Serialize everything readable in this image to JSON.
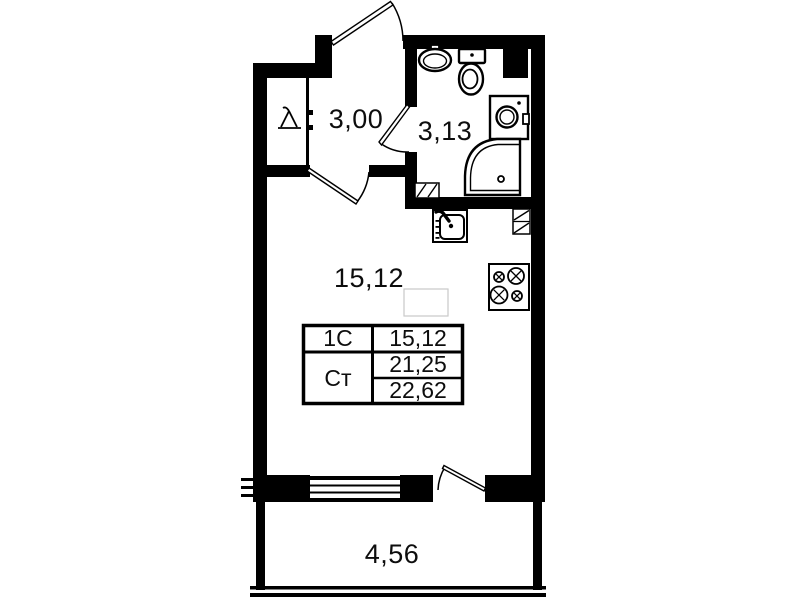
{
  "plan_title": "studio-apartment-floor-plan",
  "colors": {
    "wall": "#000000",
    "background": "#ffffff",
    "faint_outline": "#c9c9c9"
  },
  "rooms": {
    "hallway": {
      "area": "3,00"
    },
    "bathroom": {
      "area": "3,13"
    },
    "living": {
      "area": "15,12"
    },
    "balcony": {
      "area": "4,56"
    }
  },
  "area_table": {
    "row1": {
      "label": "1С",
      "value": "15,12"
    },
    "row2": {
      "label": "Ст",
      "value_top": "21,25",
      "value_bottom": "22,62"
    }
  },
  "fixtures": [
    "entrance-door",
    "wardrobe-hanger",
    "hallway-door",
    "bathroom-door",
    "bathroom-sink",
    "toilet",
    "ventilation-shaft",
    "washing-machine",
    "shower",
    "bathroom-vent-grille",
    "kitchen-sink",
    "kitchen-vent-grille",
    "stove",
    "window",
    "balcony-door",
    "balcony-glazing"
  ]
}
